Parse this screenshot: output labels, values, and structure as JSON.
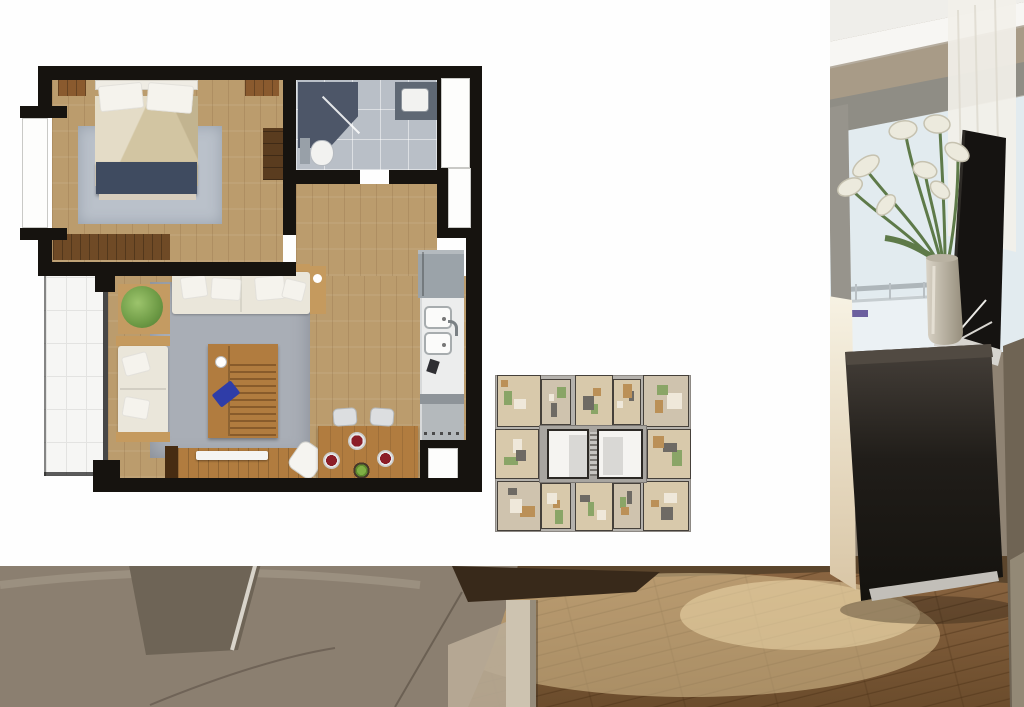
{
  "meta": {
    "kind": "real-estate-collage",
    "description": "Top-view 3D floor plan of a one-bedroom apartment and a small building key plan placed on a white panel over an interior photograph",
    "visible_text": []
  },
  "palette": {
    "wall": "#16130f",
    "wood": "#bb9c6d",
    "woodDark": "#6f4a26",
    "woodFrame": "#c59a5e",
    "tableWood": "#b17c3f",
    "rugBed": "#bac1ca",
    "rugLiving": "#a9aeb6",
    "duvet": "#d2c5a2",
    "bedBench": "#3f4b60",
    "pillowWhite": "#f5f3ed",
    "bathFloor": "#b9bfc7",
    "shower": "#4d5668",
    "vanity": "#5f6874",
    "fixture": "#f2f2f0",
    "sofaCream": "#eae6da",
    "plant": "#79a351",
    "plateRed": "#801c26",
    "bowlGreen": "#7fae44",
    "steel": "#9ba3a9",
    "counter": "#eceded",
    "cooktop": "#b4b9bc",
    "balcony": "#f6f6f4",
    "keyBase": "#b5b2ad",
    "keyUnit": "#d8c9ab",
    "keyUnitAlt": "#cfc3ae",
    "keyCore": "#a8a5a0",
    "keyWall": "#45403a",
    "keyHi": "#f5f4f1",
    "keyFurnA": "#bb9057",
    "keyFurnB": "#efe8da",
    "keyFurnC": "#8aa567",
    "keyFurnD": "#6e6a64",
    "pCeil": "#efeeea",
    "pMold": "#f7f6f3",
    "pMoldShadow": "#b5ac9e",
    "pWallTan": "#a89b87",
    "pFrame": "#8f8d85",
    "pFrameLeft": "#97948c",
    "pSky": "#e2ebef",
    "pSkyLow": "#eef3f5",
    "pCurtain": "#f2f0ea",
    "pRail": "#aeb6ba",
    "pStem": "#5e7a49",
    "pBloom": "#eceadd",
    "pBloomEdge": "#c6c2b0",
    "pVaseL": "#d9d3c6",
    "pVaseD": "#968e7c",
    "pTv": "#151311",
    "pTvStand": "#d6d4cf",
    "pCabTop": "#514a42",
    "pCab1": "#46403a",
    "pCab2": "#14120e",
    "pKick": "#c2bfb9",
    "pWallR": "#6f6454",
    "pWallR2": "#9a8f7d",
    "pLight1": "#f7f2e3",
    "pLight2": "#d9c6a6",
    "pFloor1": "#8a6541",
    "pFloor2": "#6b4c2c",
    "pFloorHi": "#e8cf9e",
    "pPlank": "#4a2f16",
    "pSofa": "#8b7f70",
    "pSofaHi": "#a79b8b",
    "pPillow": "#6e6456",
    "pPipe": "#d9d4ca",
    "pTableEdge": "#38291a",
    "pLeg": "#cdc3b0",
    "pDrawer": "#b9ac97",
    "pBottomBack": "#5b452c",
    "pBack": "#8f8373"
  },
  "floor_plan": {
    "label": "one-bedroom-unit-floor-plan",
    "rooms": [
      "bedroom",
      "bathroom",
      "hallway",
      "living-dining",
      "kitchen",
      "balcony"
    ]
  },
  "key_plan": {
    "label": "building-typical-floor-key-plan",
    "units": [
      {
        "x": 2,
        "y": 0,
        "w": 44,
        "h": 52
      },
      {
        "x": 46,
        "y": 4,
        "w": 30,
        "h": 46
      },
      {
        "x": 80,
        "y": 0,
        "w": 38,
        "h": 54
      },
      {
        "x": 118,
        "y": 4,
        "w": 28,
        "h": 46
      },
      {
        "x": 148,
        "y": 0,
        "w": 46,
        "h": 52
      },
      {
        "x": 0,
        "y": 54,
        "w": 44,
        "h": 50
      },
      {
        "x": 152,
        "y": 54,
        "w": 44,
        "h": 50
      },
      {
        "x": 2,
        "y": 106,
        "w": 44,
        "h": 50
      },
      {
        "x": 46,
        "y": 108,
        "w": 30,
        "h": 46
      },
      {
        "x": 80,
        "y": 104,
        "w": 38,
        "h": 52
      },
      {
        "x": 118,
        "y": 108,
        "w": 28,
        "h": 46
      },
      {
        "x": 148,
        "y": 106,
        "w": 46,
        "h": 50
      }
    ],
    "core": {
      "x": 44,
      "y": 50,
      "w": 108,
      "h": 58
    },
    "highlight_units": [
      {
        "x": 52,
        "y": 54,
        "w": 42,
        "h": 50,
        "inner": {
          "x": 20,
          "y": 4,
          "w": 18,
          "h": 42
        }
      },
      {
        "x": 102,
        "y": 54,
        "w": 46,
        "h": 50,
        "inner": {
          "x": 4,
          "y": 6,
          "w": 20,
          "h": 38
        }
      }
    ],
    "stairs": {
      "x": 95,
      "y": 57,
      "w": 7,
      "h": 44
    }
  },
  "photo": {
    "label": "interior-photo-background",
    "elements": [
      "ceiling-molding",
      "window",
      "sheer-curtain",
      "balcony-railing",
      "calla-lilies",
      "vase",
      "flat-tv",
      "dark-cabinet",
      "beige-wall",
      "wood-floor",
      "taupe-sofa",
      "table-edge"
    ]
  }
}
